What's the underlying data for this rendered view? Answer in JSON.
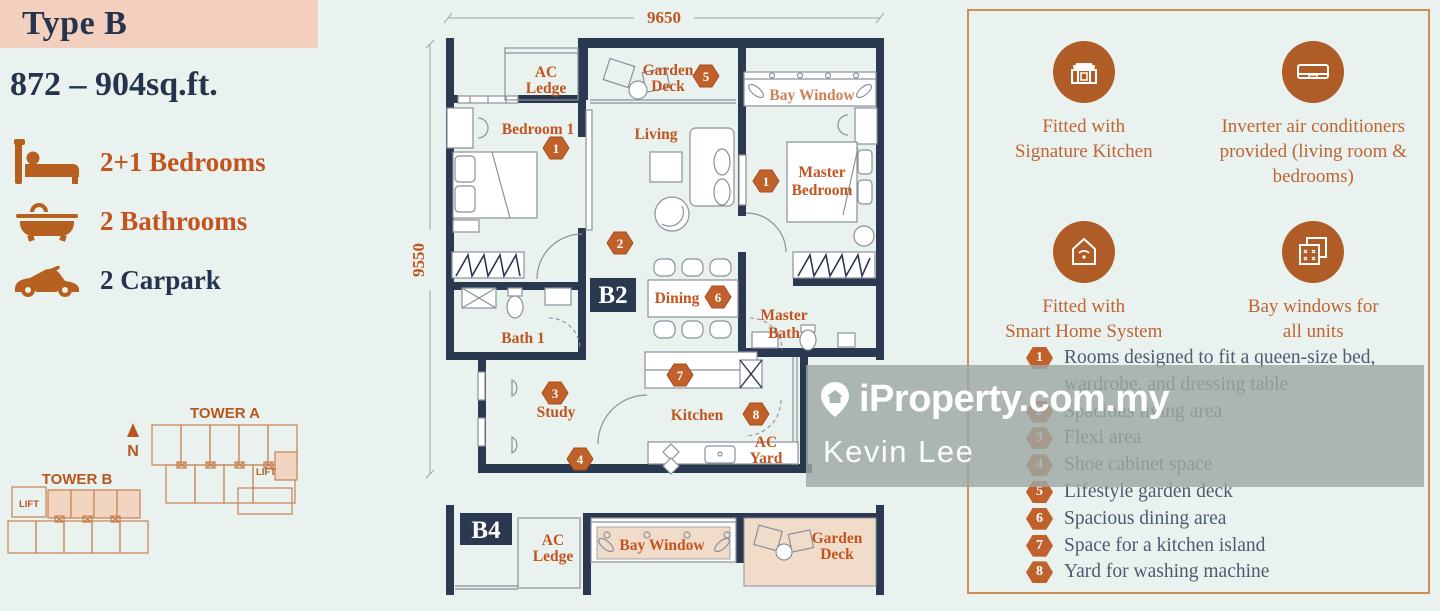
{
  "title": {
    "type": "Type B",
    "area": "872 – 904sq.ft."
  },
  "features": [
    {
      "icon": "bed-icon",
      "label": "2+1 Bedrooms"
    },
    {
      "icon": "bathtub-icon",
      "label": "2 Bathrooms"
    },
    {
      "icon": "car-icon",
      "label": "2 Carpark"
    }
  ],
  "site_plan": {
    "tower_a_label": "TOWER A",
    "tower_b_label": "TOWER B",
    "lift_label_a": "LIFT",
    "lift_label_b": "LIFT",
    "north_label": "N"
  },
  "floor_plan": {
    "dim_width": "9650",
    "dim_height": "9550",
    "unit_b2": "B2",
    "unit_b4": "B4",
    "rooms": {
      "ac_ledge": [
        "AC",
        "Ledge"
      ],
      "garden_deck": [
        "Garden",
        "Deck"
      ],
      "bay_window": "Bay Window",
      "bedroom1": "Bedroom 1",
      "living": "Living",
      "master_bedroom": [
        "Master",
        "Bedroom"
      ],
      "dining": "Dining",
      "master_bath": [
        "Master",
        "Bath"
      ],
      "bath1": "Bath 1",
      "study": "Study",
      "kitchen": "Kitchen",
      "ac_yard": [
        "AC",
        "Yard"
      ],
      "b4_ac_ledge": [
        "AC",
        "Ledge"
      ],
      "b4_bay_window": "Bay Window",
      "b4_garden_deck": [
        "Garden",
        "Deck"
      ]
    },
    "badges": {
      "bedroom1": "1",
      "master_bedroom": "1",
      "living": "2",
      "study": "3",
      "shoe": "4",
      "garden_deck": "5",
      "dining": "6",
      "kitchen": "7",
      "yard": "8"
    }
  },
  "right_panel": {
    "features": [
      {
        "icon": "kitchen-icon",
        "lines": [
          "Fitted with",
          "Signature Kitchen"
        ]
      },
      {
        "icon": "air-conditioner-icon",
        "lines": [
          "Inverter air conditioners",
          "provided (living room &",
          "bedrooms)"
        ]
      },
      {
        "icon": "smart-home-icon",
        "lines": [
          "Fitted with",
          "Smart Home System"
        ]
      },
      {
        "icon": "bay-window-icon",
        "lines": [
          "Bay windows for",
          "all units"
        ]
      }
    ],
    "legend": [
      {
        "num": "1",
        "lines": [
          "Rooms designed to fit a queen-size bed,",
          "wardrobe, and dressing table"
        ]
      },
      {
        "num": "2",
        "lines": [
          "Spacious living area"
        ]
      },
      {
        "num": "3",
        "lines": [
          "Flexi area"
        ]
      },
      {
        "num": "4",
        "lines": [
          "Shoe cabinet space"
        ]
      },
      {
        "num": "5",
        "lines": [
          "Lifestyle garden deck"
        ]
      },
      {
        "num": "6",
        "lines": [
          "Spacious dining area"
        ]
      },
      {
        "num": "7",
        "lines": [
          "Space for a kitchen island"
        ]
      },
      {
        "num": "8",
        "lines": [
          "Yard for washing machine"
        ]
      }
    ]
  },
  "watermark": {
    "brand": "iProperty.com.my",
    "agent": "Kevin Lee"
  },
  "colors": {
    "mint_bg": "#e9f2ee",
    "peach_header": "#f3d0bd",
    "navy": "#2b3950",
    "accent_orange": "#c2551f",
    "badge_orange": "#c0602a",
    "icon_circle": "#b05c26",
    "plan_peach": "#f1dcca",
    "tower_outline": "#c6824f"
  }
}
